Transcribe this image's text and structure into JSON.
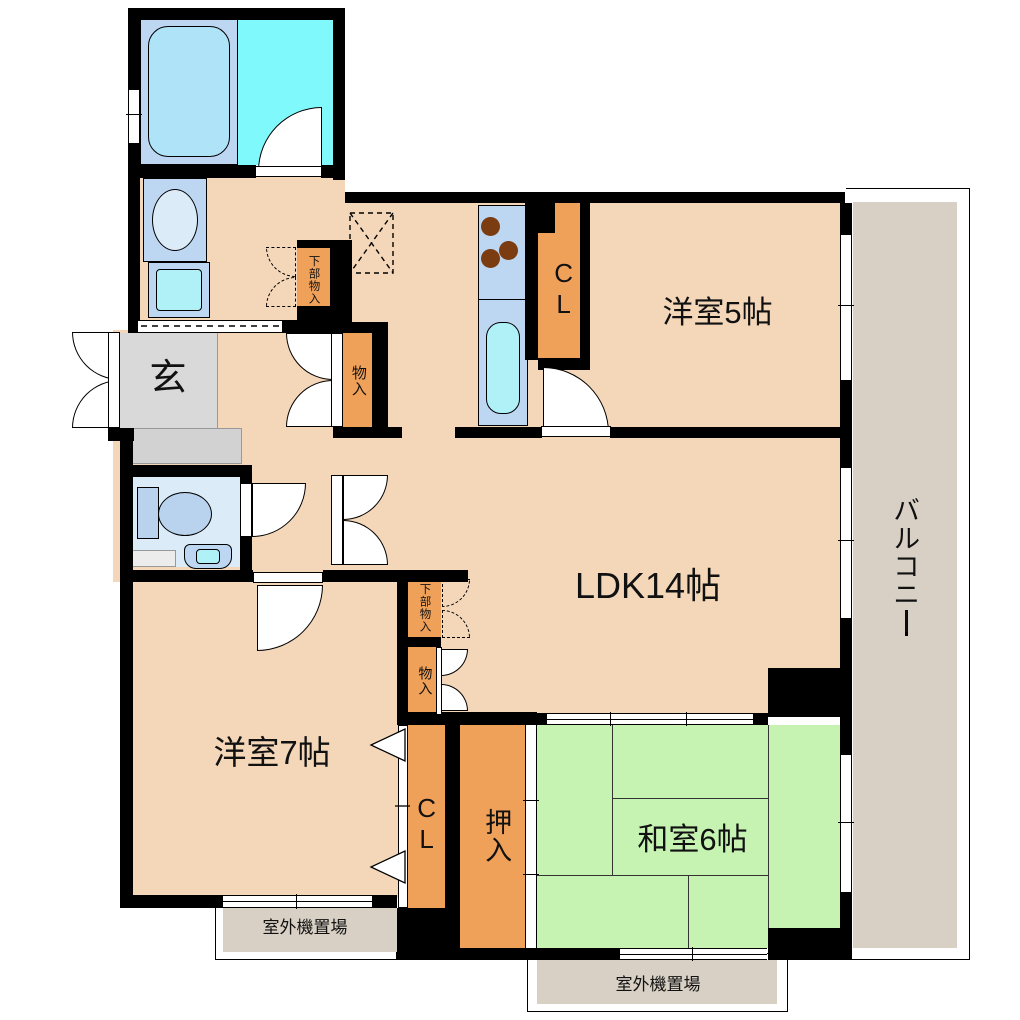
{
  "colors": {
    "wall": "#000000",
    "tan": "#f4d7b9",
    "orange": "#f0a159",
    "tatami": "#c6f2b2",
    "cyan": "#80f9fc",
    "panel_blue": "#bdd7f3",
    "fixture_blue": "#aee3f8",
    "sink_cyan": "#b0f1f8",
    "toilet_room": "#dcebf8",
    "toilet_fixture": "#b9d2ee",
    "genkan_gray": "#d9d9d9",
    "step_gray": "#d2d2d2",
    "balcony_gray": "#d8d0c5",
    "burner_brown": "#7a3c10"
  },
  "rooms": {
    "ldk": {
      "label": "LDK14帖"
    },
    "western5": {
      "label": "洋室5帖"
    },
    "western7": {
      "label": "洋室7帖"
    },
    "japanese6": {
      "label": "和室6帖"
    },
    "balcony": {
      "label": "バルコニー"
    },
    "entrance": {
      "label": "玄"
    }
  },
  "closets": {
    "cl_upper": {
      "label": "CL"
    },
    "cl_lower": {
      "label": "CL"
    },
    "oshiire": {
      "label": "押入"
    },
    "storage_hall": {
      "label": "物入"
    },
    "storage_ldk": {
      "label": "物入"
    },
    "under_storage_washroom": {
      "label": "下部物入"
    },
    "under_storage_ldk": {
      "label": "下部物入"
    }
  },
  "outdoor_units": {
    "left": {
      "label": "室外機置場"
    },
    "right": {
      "label": "室外機置場"
    }
  }
}
